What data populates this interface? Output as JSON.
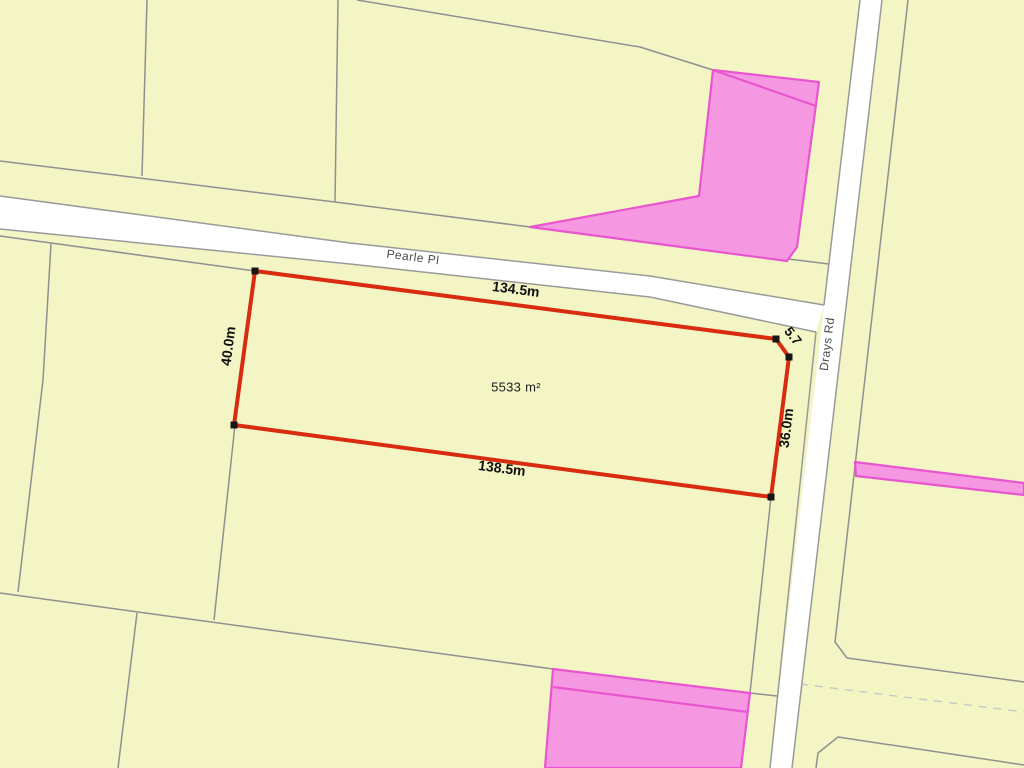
{
  "map": {
    "canvas": {
      "width": 1024,
      "height": 768,
      "background": "#f3f5c4"
    },
    "palette": {
      "parcel_line": "#909090",
      "dashed_line": "#c8c8c8",
      "road_fill": "#ffffff",
      "road_edge": "#9a9a9a",
      "highlight_fill": "#f697e2",
      "highlight_edge": "#e856cf",
      "selected_edge": "#d92b10",
      "marker": "#161616",
      "dim_text": "#111111",
      "street_text": "#4a4a4a",
      "area_text": "#1d1d1d"
    },
    "boundary_lines": [
      {
        "name": "parcel-line-topleft-vertical",
        "points": [
          [
            147,
            0
          ],
          [
            142,
            176
          ]
        ]
      },
      {
        "name": "parcel-line-top-mid-vertical",
        "points": [
          [
            338,
            0
          ],
          [
            335,
            202
          ]
        ]
      },
      {
        "name": "parcel-line-north-parallel",
        "points": [
          [
            0,
            161
          ],
          [
            335,
            202
          ],
          [
            530,
            227
          ],
          [
            829,
            264
          ]
        ]
      },
      {
        "name": "parcel-line-top-parcel",
        "points": [
          [
            357,
            0
          ],
          [
            640,
            47
          ],
          [
            713,
            70
          ]
        ]
      },
      {
        "name": "parcel-line-south-frontage-west",
        "points": [
          [
            0,
            236
          ],
          [
            255,
            271
          ]
        ]
      },
      {
        "name": "parcel-line-west-vertical-upper",
        "points": [
          [
            51,
            244
          ],
          [
            43,
            380
          ],
          [
            18,
            592
          ]
        ]
      },
      {
        "name": "parcel-line-cross",
        "points": [
          [
            0,
            593
          ],
          [
            553,
            669
          ],
          [
            750,
            693
          ],
          [
            777,
            696
          ]
        ]
      },
      {
        "name": "parcel-line-mid-vertical",
        "points": [
          [
            235,
            425
          ],
          [
            214,
            620
          ]
        ]
      },
      {
        "name": "parcel-line-bottom-vertical",
        "points": [
          [
            137,
            613
          ],
          [
            118,
            768
          ]
        ]
      },
      {
        "name": "parcel-line-drays-frontage-south",
        "points": [
          [
            771,
            497
          ],
          [
            750,
            693
          ]
        ]
      },
      {
        "name": "parcel-line-east-boundary",
        "points": [
          [
            908,
            0
          ],
          [
            835,
            642
          ],
          [
            847,
            658
          ],
          [
            1024,
            682
          ]
        ]
      },
      {
        "name": "parcel-line-dashed-easement",
        "points": [
          [
            800,
            684
          ],
          [
            1024,
            712
          ]
        ],
        "dash": true
      },
      {
        "name": "parcel-line-lower-right-parcel",
        "points": [
          [
            816,
            768
          ],
          [
            818,
            753
          ],
          [
            838,
            737
          ],
          [
            1024,
            765
          ]
        ]
      }
    ],
    "highlight_parcels": [
      {
        "name": "highlight-parcel-north",
        "points": [
          [
            713,
            70
          ],
          [
            819,
            82
          ],
          [
            797,
            247
          ],
          [
            787,
            261
          ],
          [
            530,
            227
          ],
          [
            699,
            196
          ]
        ]
      },
      {
        "name": "highlight-parcel-south",
        "points": [
          [
            553,
            669
          ],
          [
            750,
            693
          ],
          [
            741,
            768
          ],
          [
            545,
            768
          ]
        ]
      },
      {
        "name": "highlight-strip-east",
        "points": [
          [
            855,
            462
          ],
          [
            1024,
            483
          ],
          [
            1024,
            495
          ],
          [
            856,
            476
          ]
        ]
      }
    ],
    "highlight_inner_lines": [
      {
        "name": "highlight-inner-line-north",
        "points": [
          [
            713,
            70
          ],
          [
            816,
            106
          ]
        ]
      },
      {
        "name": "highlight-inner-line-south",
        "points": [
          [
            553,
            687
          ],
          [
            748,
            712
          ]
        ]
      }
    ],
    "roads": [
      {
        "name": "road-pearle-pl",
        "fill_points": [
          [
            0,
            196
          ],
          [
            350,
            243
          ],
          [
            650,
            276
          ],
          [
            824,
            305
          ],
          [
            816,
            332
          ],
          [
            650,
            297
          ],
          [
            350,
            264
          ],
          [
            0,
            229
          ]
        ],
        "edges": [
          [
            [
              0,
              196
            ],
            [
              350,
              243
            ],
            [
              650,
              276
            ],
            [
              824,
              305
            ]
          ],
          [
            [
              0,
              229
            ],
            [
              350,
              264
            ],
            [
              650,
              297
            ],
            [
              816,
              332
            ]
          ]
        ]
      },
      {
        "name": "road-drays-rd",
        "fill_points": [
          [
            860,
            0
          ],
          [
            882,
            0
          ],
          [
            792,
            768
          ],
          [
            770,
            768
          ]
        ],
        "edges": [
          [
            [
              860,
              0
            ],
            [
              824,
              305
            ]
          ],
          [
            [
              816,
              332
            ],
            [
              770,
              768
            ]
          ],
          [
            [
              882,
              0
            ],
            [
              792,
              768
            ]
          ]
        ]
      }
    ],
    "selected_parcel": {
      "name": "selected-parcel-outline",
      "points": [
        [
          255,
          271
        ],
        [
          776,
          339
        ],
        [
          789,
          357
        ],
        [
          771,
          497
        ],
        [
          234,
          425
        ]
      ],
      "stroke_width": 4,
      "marker_size": 7,
      "vertices": [
        [
          255,
          271
        ],
        [
          776,
          339
        ],
        [
          789,
          357
        ],
        [
          771,
          497
        ],
        [
          234,
          425
        ]
      ]
    },
    "labels": [
      {
        "name": "street-label-pearle-pl",
        "text": "Pearle Pl",
        "x": 413,
        "y": 257,
        "rot": 7.3,
        "size": 12,
        "weight": "normal",
        "color": "#4a4a4a",
        "spacing": 0.5
      },
      {
        "name": "street-label-drays-rd",
        "text": "Drays Rd",
        "x": 827,
        "y": 344,
        "rot": -83,
        "size": 12,
        "weight": "normal",
        "color": "#4a4a4a",
        "spacing": 0.5
      },
      {
        "name": "dim-label-top",
        "text": "134.5m",
        "x": 516,
        "y": 289,
        "rot": 7.4,
        "size": 14,
        "weight": "bold",
        "color": "#111111",
        "spacing": 0
      },
      {
        "name": "dim-label-bottom",
        "text": "138.5m",
        "x": 502,
        "y": 468,
        "rot": 7.4,
        "size": 14,
        "weight": "bold",
        "color": "#111111",
        "spacing": 0
      },
      {
        "name": "dim-label-left",
        "text": "40.0m",
        "x": 228,
        "y": 346,
        "rot": -82.5,
        "size": 14,
        "weight": "bold",
        "color": "#111111",
        "spacing": 0
      },
      {
        "name": "dim-label-right",
        "text": "36.0m",
        "x": 786,
        "y": 428,
        "rot": -83,
        "size": 14,
        "weight": "bold",
        "color": "#111111",
        "spacing": 0
      },
      {
        "name": "dim-label-chamfer",
        "text": "5.7",
        "x": 793,
        "y": 336,
        "rot": 52,
        "size": 13.5,
        "weight": "bold",
        "color": "#111111",
        "spacing": 0
      },
      {
        "name": "area-label",
        "text": "5533 m²",
        "x": 516,
        "y": 387,
        "rot": 0,
        "size": 13,
        "weight": "normal",
        "color": "#1d1d1d",
        "spacing": 0.3
      }
    ]
  }
}
